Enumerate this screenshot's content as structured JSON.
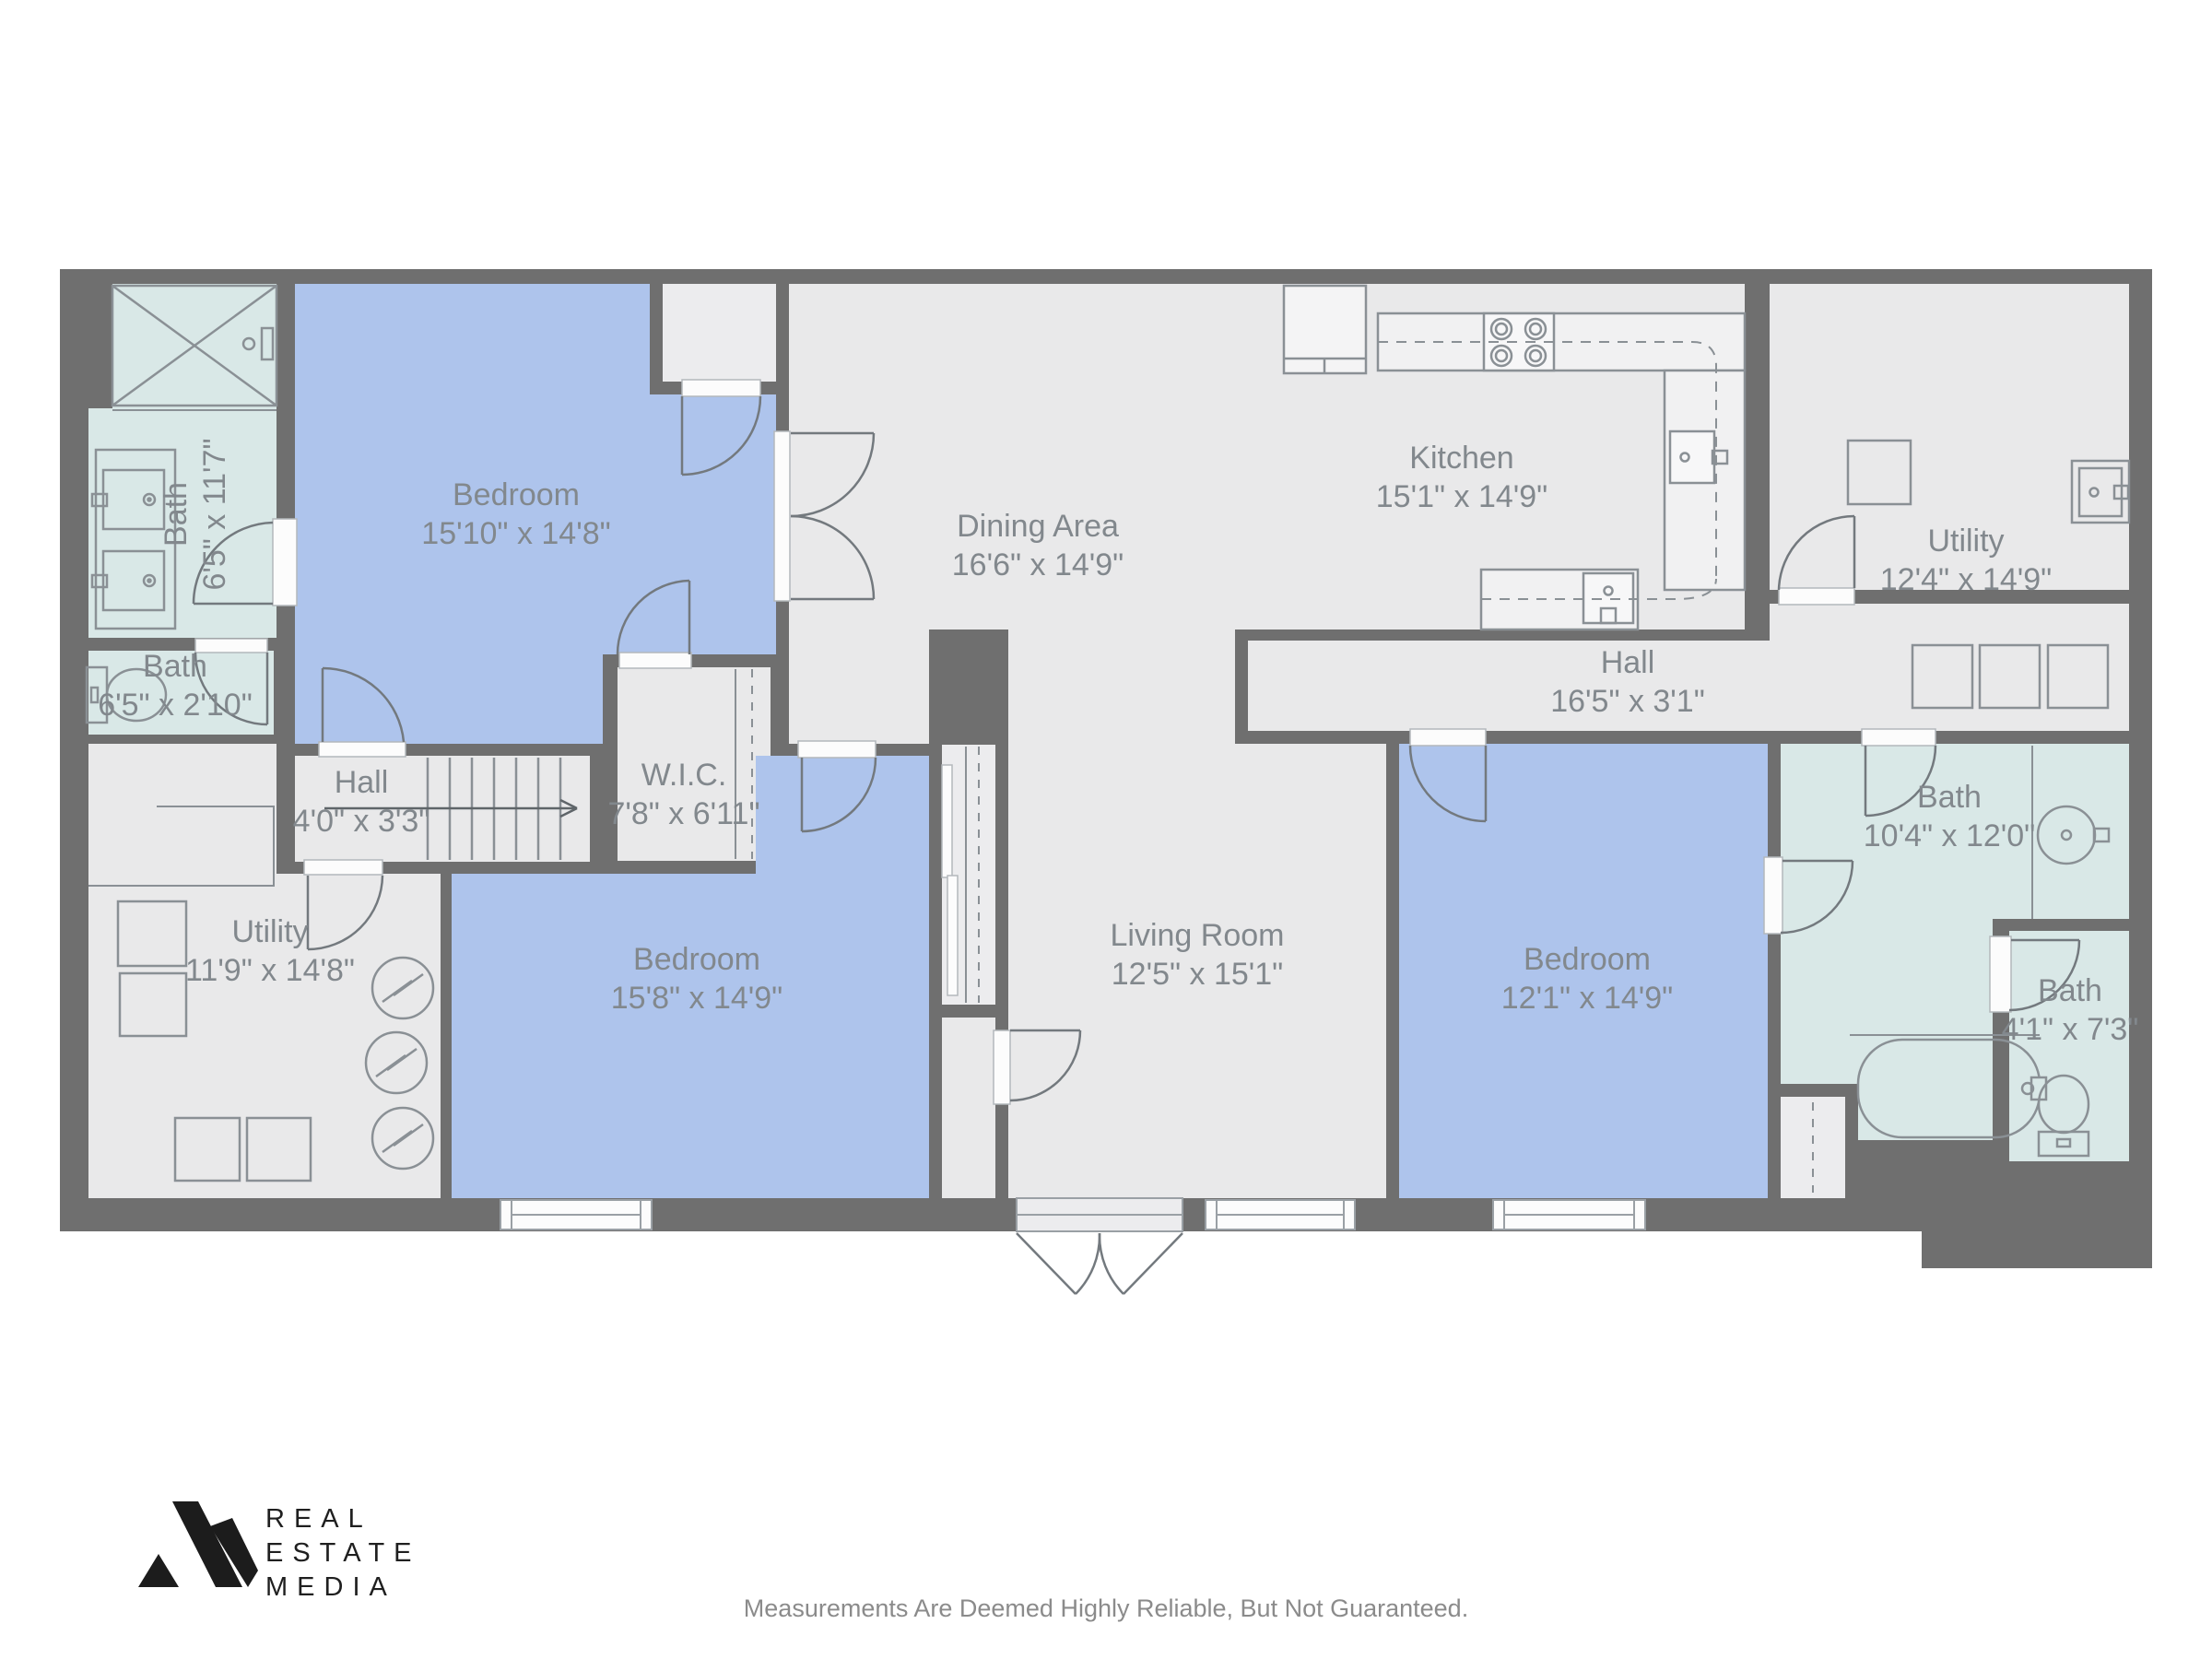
{
  "rooms": {
    "bath_main": {
      "name": "Bath",
      "dims": "6'5\" x 11'7\""
    },
    "bath_wc": {
      "name": "Bath",
      "dims": "6'5\" x 2'10\""
    },
    "bedroom1": {
      "name": "Bedroom",
      "dims": "15'10\" x 14'8\""
    },
    "dining": {
      "name": "Dining Area",
      "dims": "16'6\" x 14'9\""
    },
    "kitchen": {
      "name": "Kitchen",
      "dims": "15'1\" x 14'9\""
    },
    "utility_right": {
      "name": "Utility",
      "dims": "12'4\" x 14'9\""
    },
    "hall_right": {
      "name": "Hall",
      "dims": "16'5\" x 3'1\""
    },
    "hall_left": {
      "name": "Hall",
      "dims": "4'0\" x 3'3\""
    },
    "wic": {
      "name": "W.I.C.",
      "dims": "7'8\" x 6'11\""
    },
    "utility_left": {
      "name": "Utility",
      "dims": "11'9\" x 14'8\""
    },
    "bedroom2": {
      "name": "Bedroom",
      "dims": "15'8\" x 14'9\""
    },
    "living": {
      "name": "Living Room",
      "dims": "12'5\" x 15'1\""
    },
    "bedroom3": {
      "name": "Bedroom",
      "dims": "12'1\" x 14'9\""
    },
    "bath_right": {
      "name": "Bath",
      "dims": "10'4\" x 12'0\""
    },
    "bath_small": {
      "name": "Bath",
      "dims": "4'1\" x 7'3\""
    }
  },
  "logo": {
    "line1": "REAL",
    "line2": "ESTATE",
    "line3": "MEDIA"
  },
  "footer": {
    "disclaimer": "Measurements Are Deemed Highly Reliable, But Not Guaranteed."
  },
  "colors": {
    "wall": "#6f6f6f",
    "floor": "#e9e9ea",
    "bedroom_floor": "#aec4ec",
    "bath_floor": "#d9e8e7",
    "label_text": "#82888d",
    "logo_text": "#1f1f1f"
  }
}
